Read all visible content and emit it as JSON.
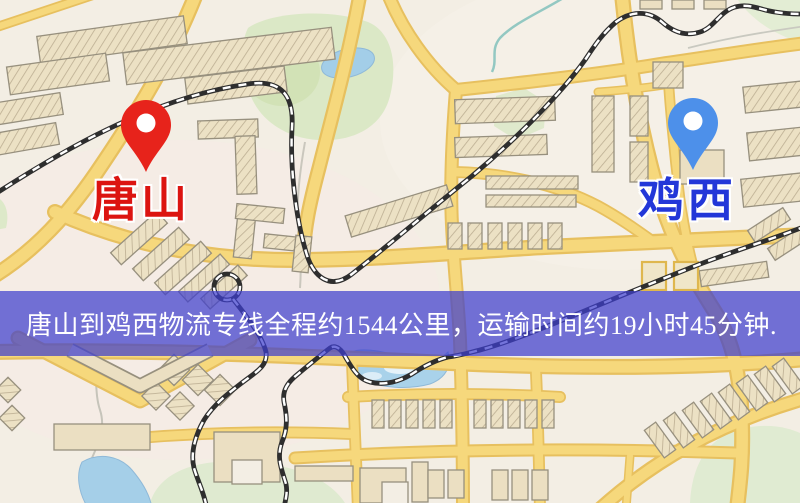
{
  "map": {
    "origin": {
      "label": "唐山",
      "marker": "red-location-pin",
      "marker_color": "#e7231b",
      "label_color": "#dc1410"
    },
    "destination": {
      "label": "鸡西",
      "marker": "blue-location-pin",
      "marker_color": "#4d90ea",
      "label_color": "#2337d8"
    },
    "banner": {
      "text": "唐山到鸡西物流专线全程约1544公里，运输时间约19小时45分钟.",
      "bg_color": "rgba(62,62,205,0.72)",
      "text_color": "#ffffff"
    },
    "route": {
      "from": "唐山",
      "to": "鸡西",
      "distance": "约1544公里",
      "duration": "约19小时45分钟"
    },
    "colors": {
      "background": "#f3eee4",
      "road_fill": "#f6d87c",
      "road_casing": "#e7c05f",
      "building_fill": "#ece1c4",
      "building_outline": "#97907e",
      "park_green": "#dbe8c6",
      "water_blue": "#a5cfe8",
      "railway_dark": "#2e2e2e"
    }
  }
}
